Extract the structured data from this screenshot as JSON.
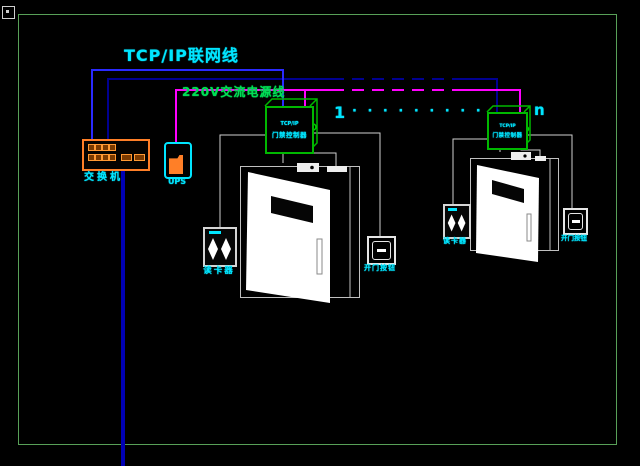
{
  "titles": {
    "network_line": "TCP/IP联网线",
    "power_line": "220V交流电源线"
  },
  "switch": {
    "label": "交换机"
  },
  "ups": {
    "label": "UPS"
  },
  "controllers": {
    "brand": "TCP/IP",
    "name": "门禁控制器"
  },
  "doors": {
    "first_index": "1",
    "ellipsis": "· · ·  · · ·  · · ·",
    "last_index": "n",
    "reader_label": "读卡器",
    "button_label": "开门按钮"
  },
  "colors": {
    "network_drop_blue": "#2a2aff",
    "network_backbone_navy": "#000090",
    "power_magenta": "#ff00ff",
    "label_cyan": "#00e5ff",
    "power_title_green": "#00dd55",
    "device_green": "#00b800",
    "device_orange": "#ff7f27",
    "sheet_border_green": "#58a058"
  }
}
